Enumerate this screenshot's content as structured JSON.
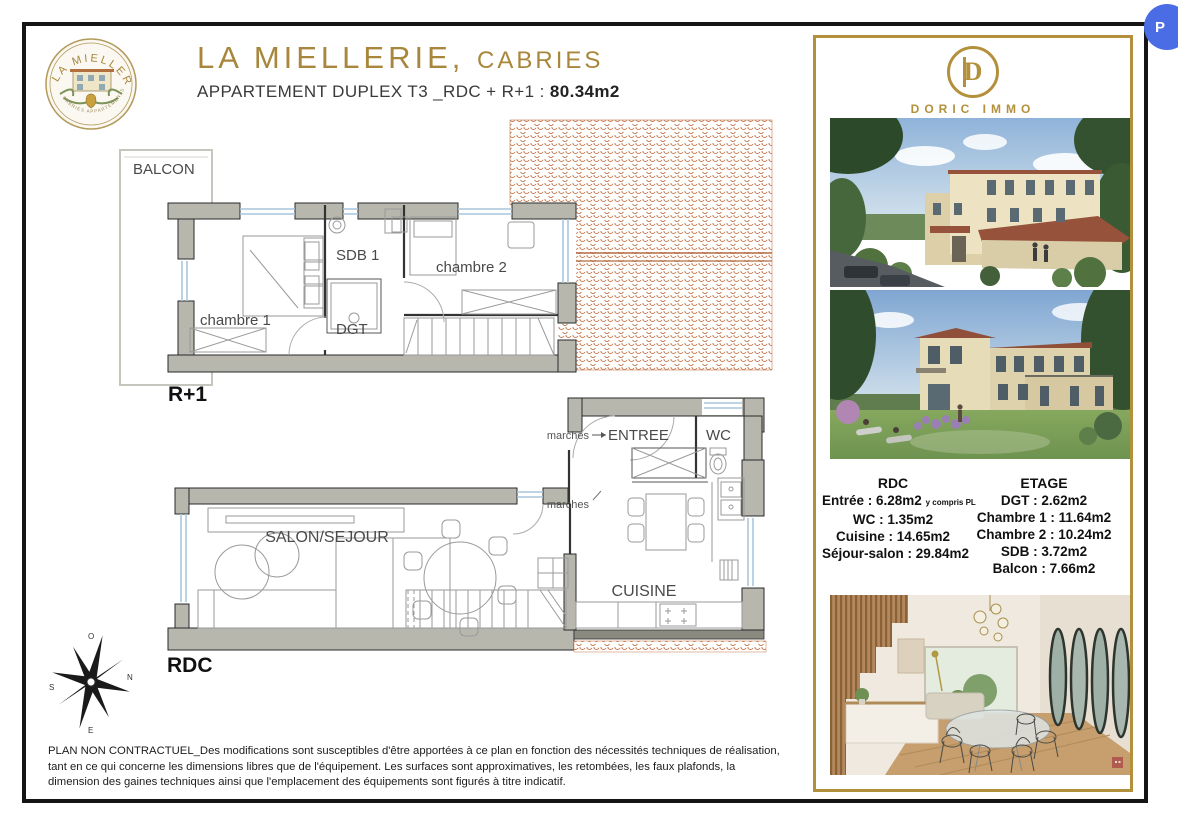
{
  "page": {
    "p_overlay": "P"
  },
  "header": {
    "title": "LA MIELLERIE,",
    "title_city": "CABRIES",
    "subtitle": "APPARTEMENT DUPLEX T3 _RDC + R+1 :",
    "subtitle_area": "80.34m2",
    "badge_top": "LA MIELLERIE",
    "badge_bottom": "CABRIES APPARTEMENTS D'EXCEPTION"
  },
  "plan": {
    "balcon": "BALCON",
    "chambre1": "chambre 1",
    "sdb1": "SDB 1",
    "dgt": "DGT",
    "chambre2": "chambre 2",
    "r1": "R+1",
    "entree": "ENTREE",
    "wc": "WC",
    "marches_top": "marches",
    "marches_mid": "marches",
    "salon": "SALON/SEJOUR",
    "cuisine": "CUISINE",
    "rdc": "RDC"
  },
  "compass": {
    "o": "O",
    "n": "N",
    "e": "E",
    "s": "S"
  },
  "panel": {
    "brand_letter": "D",
    "brand_name": "DORIC IMMO",
    "surfaces_rdc": {
      "title": "RDC",
      "line1": "Entrée : 6.28m2",
      "line1_note": "y compris PL",
      "line2": "WC : 1.35m2",
      "line3": "Cuisine : 14.65m2",
      "line4": "Séjour-salon : 29.84m2"
    },
    "surfaces_etage": {
      "title": "ETAGE",
      "line1": "DGT : 2.62m2",
      "line2": "Chambre 1 : 11.64m2",
      "line3": "Chambre 2 : 10.24m2",
      "line4": "SDB : 3.72m2",
      "line5": "Balcon : 7.66m2"
    }
  },
  "footer": {
    "line1": "PLAN NON CONTRACTUEL_Des modifications sont susceptibles d'être apportées à ce plan en fonction  des nécessités techniques de réalisation,",
    "line2": "tant en ce qui concerne les dimensions libres que de l'équipement. Les surfaces sont approximatives, les retombées, les faux plafonds, la",
    "line3": "dimension des gaines techniques ainsi que l'emplacement des équipements sont figurés à titre indicatif."
  },
  "colors": {
    "gold": "#a8873c",
    "wall_grey": "#b7b7ad",
    "tile_orange": "#c4794d",
    "window_blue": "#a9c6dc",
    "p_button_blue": "#4a6de5"
  }
}
